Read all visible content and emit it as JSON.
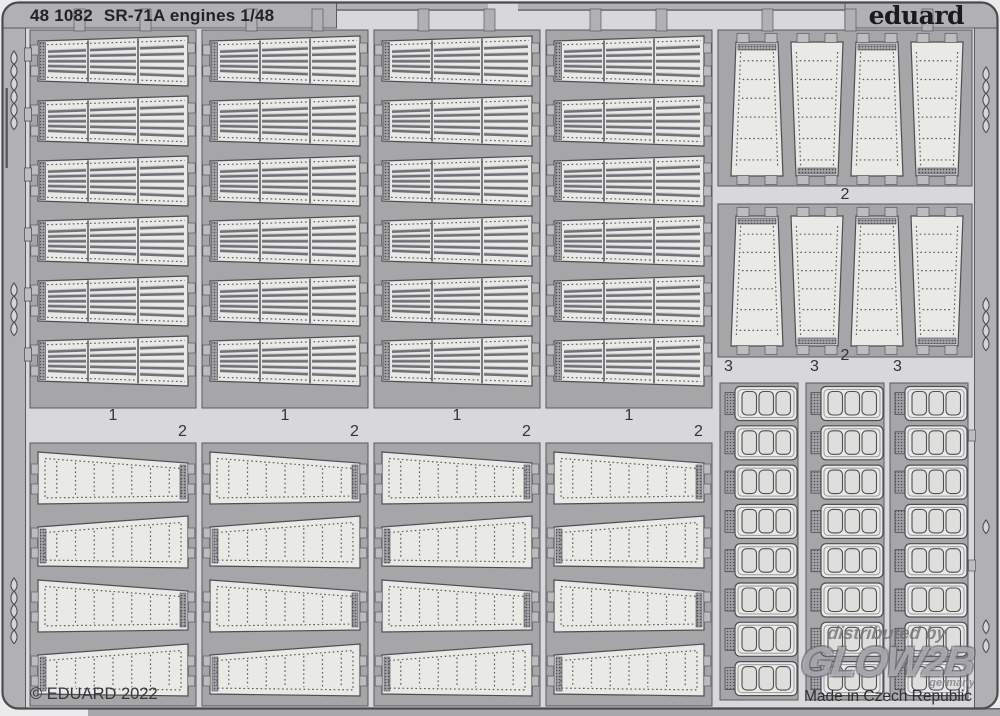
{
  "sheet": {
    "code": "48 1082",
    "name": "SR-71A engines 1/48",
    "brand": "eduard",
    "copyright": "© EDUARD 2022",
    "made_in": "Made in Czech Republic",
    "watermark": {
      "line1": "distributed by",
      "line2": "GLOW2B",
      "line3": "germany"
    }
  },
  "parts": {
    "louver_panel_columns": {
      "label": "1",
      "columns": 4,
      "rows": 6,
      "segments_per_panel": 3,
      "louvers_per_segment": 5
    },
    "wide_strip_columns": {
      "label": "2",
      "columns": 4,
      "rows": 4
    },
    "vertical_strip_groups": [
      {
        "label": "2",
        "strips": 4
      },
      {
        "label": "2",
        "strips": 4
      }
    ],
    "grid_part_columns": {
      "label": "3",
      "columns": 3,
      "rows": 8,
      "openings_per_part": 3
    }
  },
  "colors": {
    "background": "#ebebec",
    "open_area": "#d8d8da",
    "rail": "#b1b1b4",
    "frame": "#a6a6a9",
    "panel": "#e9e9e6",
    "hole": "#dededc",
    "line": "#4e4e54",
    "edge": "#5a5a60",
    "louver_bar": "#717177",
    "louver_highlight": "#cdcdd1",
    "hatch_bg": "#a3a3a7",
    "tab": "#bdbdc0",
    "tab_dark": "#85858b",
    "under_strip": "#a8a8ab",
    "text": "#26262a",
    "label": "#333338"
  }
}
